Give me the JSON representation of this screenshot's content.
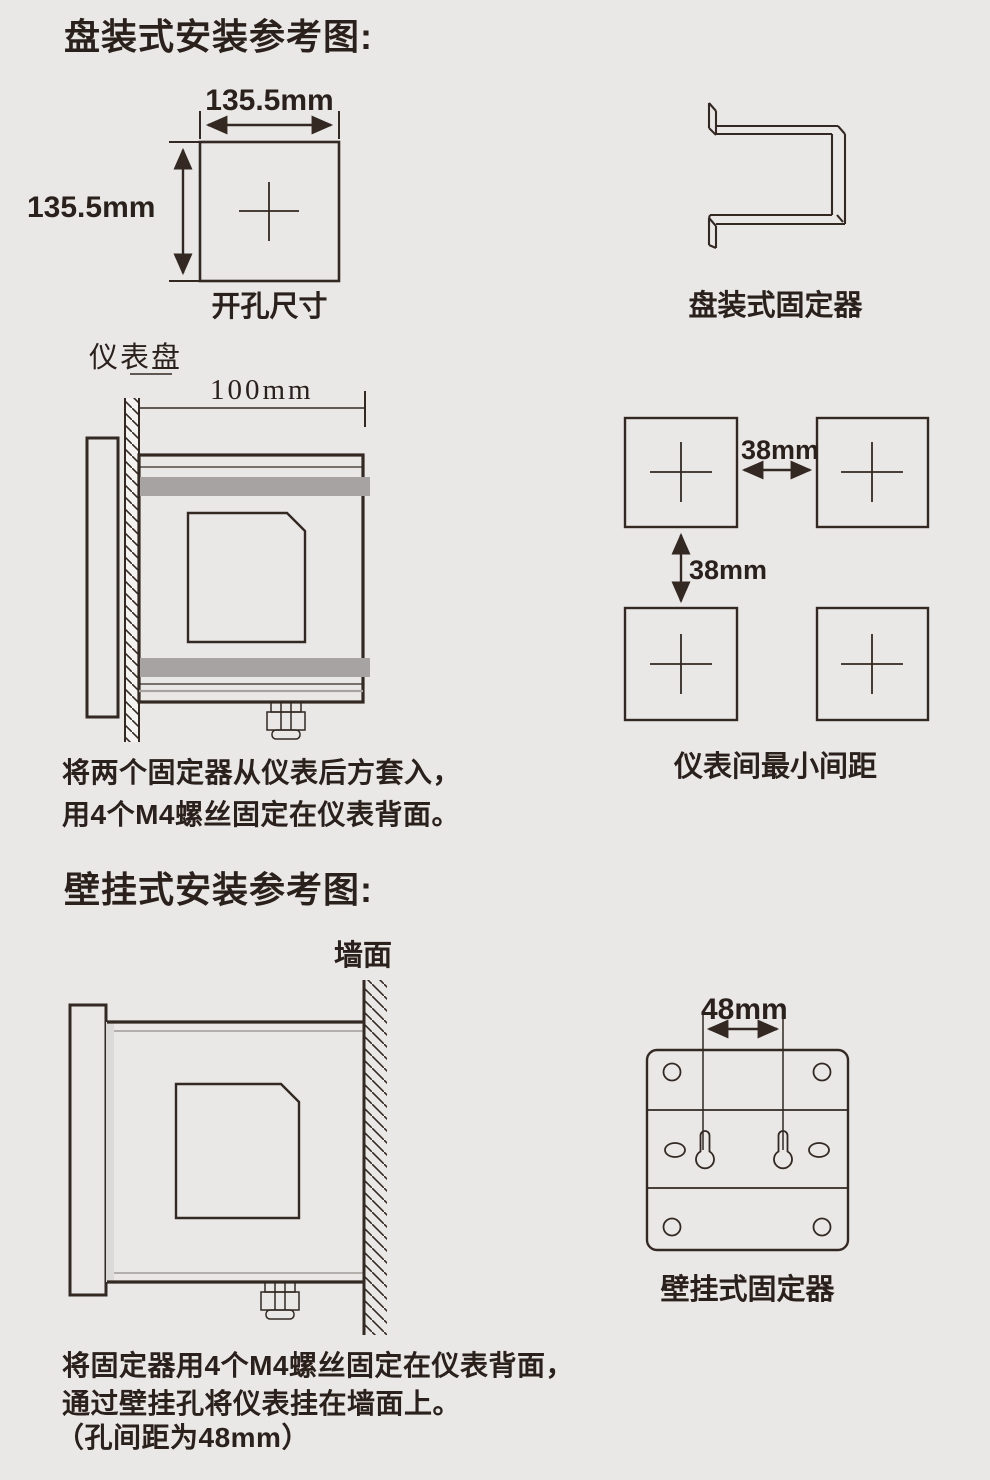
{
  "colors": {
    "background": "#eae8e6",
    "line": "#332922",
    "gray_bar": "#a7a3a2",
    "light_strip": "#dcdad8"
  },
  "panel_section": {
    "title": "盘装式安装参考图:",
    "cutout": {
      "width_label": "135.5mm",
      "height_label": "135.5mm",
      "caption": "开孔尺寸"
    },
    "bracket": {
      "caption": "盘装式固定器"
    },
    "side_view": {
      "panel_label": "仪表盘",
      "depth_label": "100mm"
    },
    "spacing": {
      "horizontal_label": "38mm",
      "vertical_label": "38mm",
      "caption": "仪表间最小间距"
    },
    "note_line1": "将两个固定器从仪表后方套入，",
    "note_line2": "用4个M4螺丝固定在仪表背面。"
  },
  "wall_section": {
    "title": "壁挂式安装参考图:",
    "side_view": {
      "wall_label": "墙面"
    },
    "fixer": {
      "hole_distance_label": "48mm",
      "caption": "壁挂式固定器"
    },
    "note_line1": "将固定器用4个M4螺丝固定在仪表背面，",
    "note_line2": "通过壁挂孔将仪表挂在墙面上。",
    "note_line3": "（孔间距为48mm）"
  }
}
